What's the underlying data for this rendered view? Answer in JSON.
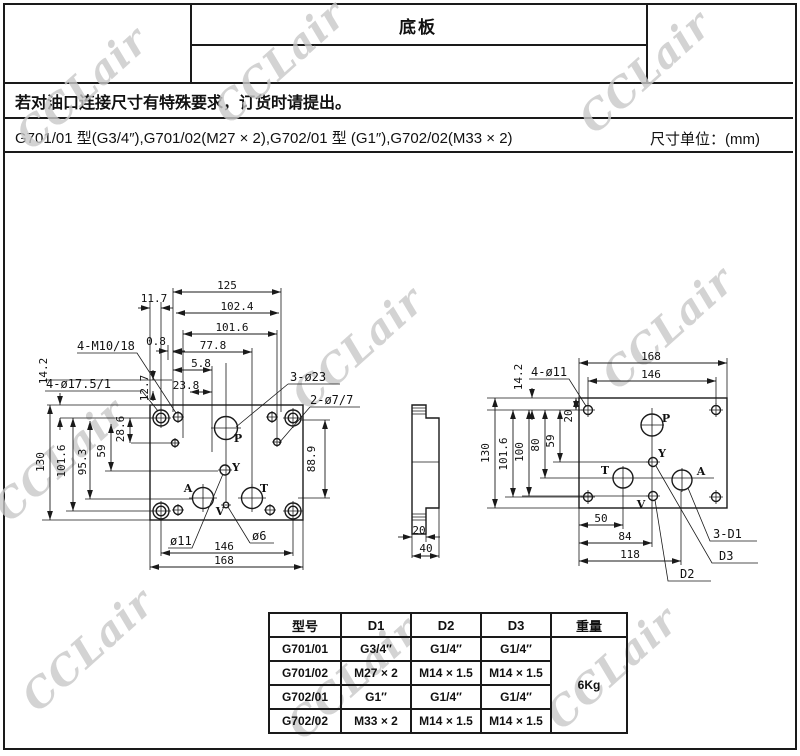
{
  "header": {
    "title": "底板",
    "note": "若对油口连接尺寸有特殊要求，订货时请提出。",
    "models_line": "G701/01 型(G3/4″),G701/02(M27 × 2),G702/01 型 (G1″),G702/02(M33 × 2)",
    "unit_label": "尺寸单位：(mm)"
  },
  "watermark": {
    "text": "CCLair",
    "color": "#c9c9c9"
  },
  "front_view": {
    "top_dims": {
      "d125": "125",
      "d11_7": "11.7",
      "d102_4": "102.4",
      "d101_6": "101.6",
      "d77_8": "77.8",
      "d0_8": "0.8",
      "d5_8": "5.8",
      "d23_8": "23.8"
    },
    "left_dims": {
      "d14_2": "14.2",
      "d130": "130",
      "d101_6": "101.6",
      "d95_3": "95.3",
      "d59": "59",
      "d28_6": "28.6",
      "d12_7": "12.7"
    },
    "right_dims": {
      "d88_9": "88.9"
    },
    "bottom_dims": {
      "d146": "146",
      "d168": "168"
    },
    "labels": {
      "m10": "4-M10/18",
      "c17_5": "4-ø17.5/1",
      "c23": "3-ø23",
      "c7": "2-ø7/7",
      "c11": "ø11",
      "c6": "ø6"
    },
    "ports": {
      "p": "P",
      "y": "Y",
      "a": "A",
      "t": "T",
      "v": "V"
    }
  },
  "side_view": {
    "d20": "20",
    "d40": "40"
  },
  "bottom_view": {
    "top_dims": {
      "d168": "168",
      "d146": "146",
      "d14_2": "14.2"
    },
    "left_dims": {
      "d130": "130",
      "d101_6": "101.6",
      "d100": "100",
      "d80": "80",
      "d59": "59",
      "d20": "20"
    },
    "bottom_dims": {
      "d50": "50",
      "d84": "84",
      "d118": "118"
    },
    "labels": {
      "c11": "4-ø11",
      "d1": "3-D1",
      "d3": "D3",
      "d2": "D2"
    },
    "ports": {
      "p": "P",
      "y": "Y",
      "a": "A",
      "t": "T",
      "v": "V"
    }
  },
  "spec_table": {
    "headers": [
      "型号",
      "D1",
      "D2",
      "D3",
      "重量"
    ],
    "rows": [
      [
        "G701/01",
        "G3/4″",
        "G1/4″",
        "G1/4″"
      ],
      [
        "G701/02",
        "M27 × 2",
        "M14 × 1.5",
        "M14 × 1.5"
      ],
      [
        "G702/01",
        "G1″",
        "G1/4″",
        "G1/4″"
      ],
      [
        "G702/02",
        "M33 × 2",
        "M14 × 1.5",
        "M14 × 1.5"
      ]
    ],
    "weight": "6Kg"
  }
}
